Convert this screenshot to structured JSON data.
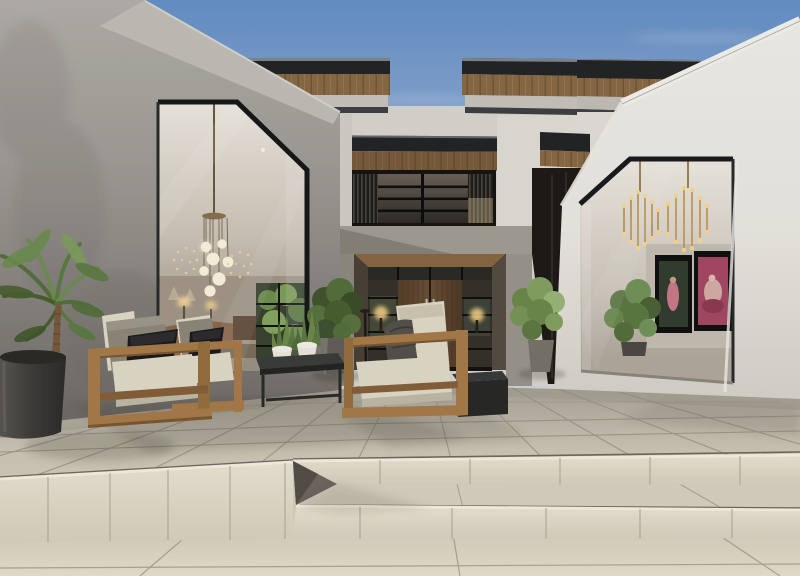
{
  "scene": {
    "type": "architectural-exterior-render",
    "description": "Photorealistic render of a modern luxury villa patio: grey concrete and white stucco volumes with huge chamfered glass openings, floating dark roof slabs with timber soffits, central timber entry door, wooden lounge chairs with cream cushions, marble tile terrace with wide steps, palm in a charcoal planter.",
    "objects": [
      "sky",
      "left-concrete-volume",
      "right-white-volume",
      "main-house-roofs",
      "clerestory-window",
      "entry-door",
      "entry-side-lights",
      "globe-pendant-chandelier",
      "sparkle-chandeliers",
      "brass-chandeliers",
      "artwork-dark",
      "artwork-pink",
      "interior-garden-window",
      "palm-planter",
      "entry-shrub-left",
      "entry-plant-right",
      "indoor-plant-right",
      "lounge-chair-front",
      "lounge-chair-middle",
      "lounge-chair-right",
      "throw-blanket",
      "coffee-table",
      "snake-plant-pots",
      "side-table",
      "patio-floor",
      "patio-steps",
      "step-wedge"
    ]
  },
  "palette": {
    "sky-top": "#6691c9",
    "sky-horizon": "#c6d6ea",
    "concrete": "#9d9994",
    "concrete-dark": "#6e6a66",
    "concrete-light": "#c6c3be",
    "white-wall": "#eceae4",
    "white-wall-shade": "#d8d5ce",
    "fascia": "#222426",
    "wood-soffit": "#8a6a45",
    "wood-door": "#6e5137",
    "wood-furniture": "#a87c4a",
    "wood-furniture-dark": "#87603a",
    "cushion-cream": "#e2dcca",
    "cushion-gray": "#8f897c",
    "pillow-black": "#1b1b1d",
    "tile": "#cec8b8",
    "tile-light": "#e2dccb",
    "tile-grout": "#968f80",
    "riser": "#ece6d6",
    "glass-dark": "#35312b",
    "glow-warm": "#ffd98a",
    "plant-green": "#5f7a45",
    "plant-green-light": "#85a263",
    "planter-dark": "#3e3c39",
    "art-pink": "#a64a66",
    "art-dark": "#333d30",
    "throw-gray": "#55524d"
  }
}
